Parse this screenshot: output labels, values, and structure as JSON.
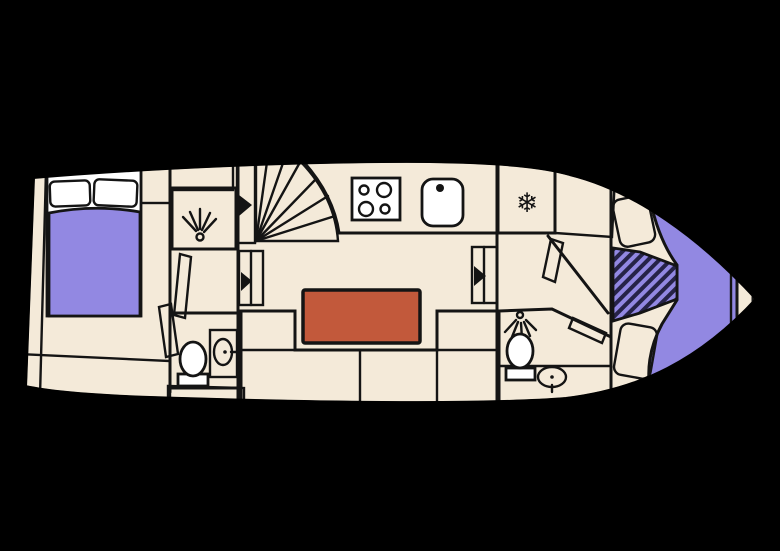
{
  "plan": {
    "type": "boat-deck-floor-plan",
    "icons": {
      "snowflake": "❄"
    }
  },
  "colors": {
    "background": "#000000",
    "floor": "#f4ead9",
    "hull_trim": "#b8603e",
    "galley_counter": "#7e9c87",
    "stairs": "#bdb172",
    "cabinet": "#bdb172",
    "sofa": "#f5b61d",
    "table": "#c2593b",
    "bathroom": "#d9eef7",
    "bathroom_counter": "#9cc3da",
    "sink_panel": "#aed0e2",
    "bed": "#9288e2",
    "pillow": "#c9c2f1",
    "hatch_stripe": "#262347",
    "fixture_white": "#ffffff"
  }
}
